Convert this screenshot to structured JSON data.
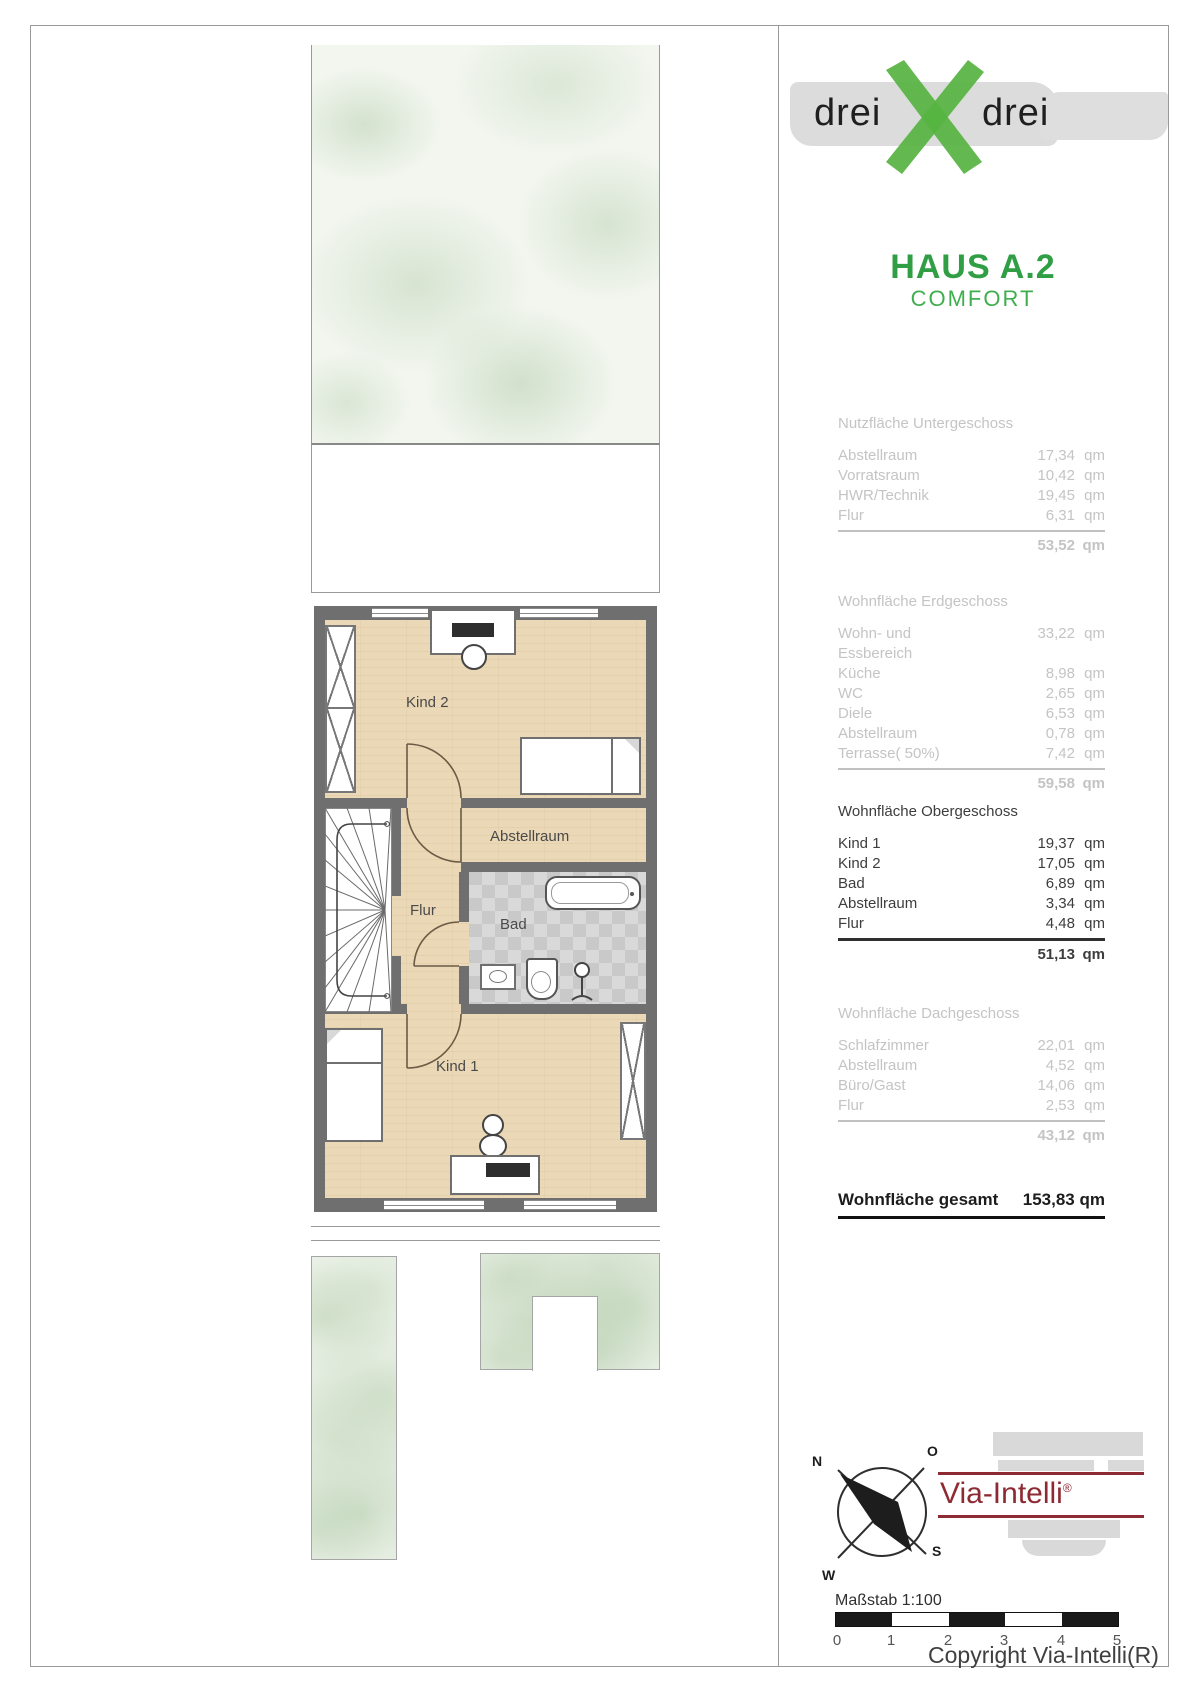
{
  "brand": {
    "word_left": "drei",
    "word_right": "drei"
  },
  "header": {
    "title": "HAUS A.2",
    "subtitle": "COMFORT"
  },
  "sections": {
    "s1": {
      "title": "Nutzfläche Untergeschoss",
      "rows": [
        {
          "label": "Abstellraum",
          "value": "17,34",
          "unit": "qm"
        },
        {
          "label": "Vorratsraum",
          "value": "10,42",
          "unit": "qm"
        },
        {
          "label": "HWR/Technik",
          "value": "19,45",
          "unit": "qm"
        },
        {
          "label": "Flur",
          "value": "6,31",
          "unit": "qm"
        }
      ],
      "total_value": "53,52",
      "total_unit": "qm"
    },
    "s2": {
      "title": "Wohnfläche Erdgeschoss",
      "rows": [
        {
          "label": "Wohn- und Essbereich",
          "value": "33,22",
          "unit": "qm"
        },
        {
          "label": "Küche",
          "value": "8,98",
          "unit": "qm"
        },
        {
          "label": "WC",
          "value": "2,65",
          "unit": "qm"
        },
        {
          "label": "Diele",
          "value": "6,53",
          "unit": "qm"
        },
        {
          "label": "Abstellraum",
          "value": "0,78",
          "unit": "qm"
        },
        {
          "label": "Terrasse( 50%)",
          "value": "7,42",
          "unit": "qm"
        }
      ],
      "total_value": "59,58",
      "total_unit": "qm"
    },
    "s3": {
      "title": "Wohnfläche Obergeschoss",
      "rows": [
        {
          "label": "Kind 1",
          "value": "19,37",
          "unit": "qm"
        },
        {
          "label": "Kind 2",
          "value": "17,05",
          "unit": "qm"
        },
        {
          "label": "Bad",
          "value": "6,89",
          "unit": "qm"
        },
        {
          "label": "Abstellraum",
          "value": "3,34",
          "unit": "qm"
        },
        {
          "label": "Flur",
          "value": "4,48",
          "unit": "qm"
        }
      ],
      "total_value": "51,13",
      "total_unit": "qm"
    },
    "s4": {
      "title": "Wohnfläche Dachgeschoss",
      "rows": [
        {
          "label": "Schlafzimmer",
          "value": "22,01",
          "unit": "qm"
        },
        {
          "label": "Abstellraum",
          "value": "4,52",
          "unit": "qm"
        },
        {
          "label": "Büro/Gast",
          "value": "14,06",
          "unit": "qm"
        },
        {
          "label": "Flur",
          "value": "2,53",
          "unit": "qm"
        }
      ],
      "total_value": "43,12",
      "total_unit": "qm"
    }
  },
  "grand_total": {
    "label": "Wohnfläche gesamt",
    "value": "153,83 qm"
  },
  "floorplan": {
    "labels": {
      "kind2": "Kind 2",
      "abstellraum": "Abstellraum",
      "flur": "Flur",
      "bad": "Bad",
      "kind1": "Kind 1"
    }
  },
  "compass": {
    "north": "N",
    "east": "O",
    "south": "S",
    "west": "W"
  },
  "vendor": {
    "name": "Via-Intelli",
    "registered": "®"
  },
  "scalebar": {
    "label": "Maßstab 1:100",
    "ticks": [
      "0",
      "1",
      "2",
      "3",
      "4",
      "5"
    ]
  },
  "copyright": "Copyright Via-Intelli(R)",
  "colors": {
    "accent_green": "#2f9e44",
    "logo_x_green": "#56b340",
    "vendor_red": "#8e2a33"
  }
}
